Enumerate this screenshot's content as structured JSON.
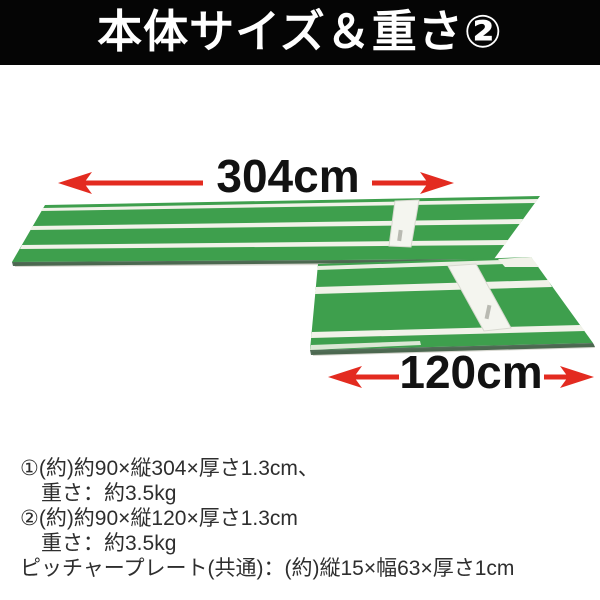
{
  "header": {
    "title": "本体サイズ＆重さ②",
    "bg_color": "#050505",
    "text_color": "#ffffff"
  },
  "diagram": {
    "long_mat": {
      "name": "投球練習マット(ロング)",
      "dimension_label": "304cm"
    },
    "short_mat": {
      "name": "投球練習マット(ショート)",
      "dimension_label": "120cm"
    },
    "colors": {
      "arrow_red": "#e32b20",
      "mat_green": "#3e9f4d",
      "stripe_white": "#f1f2e9",
      "plate_white": "#f4f5ef",
      "edge_dark": "#33543a"
    }
  },
  "specs": {
    "lines": [
      {
        "text": "①(約)約90×縦304×厚さ1.3cm、",
        "indent": false
      },
      {
        "text": "重さ：約3.5kg",
        "indent": true
      },
      {
        "text": "②(約)約90×縦120×厚さ1.3cm",
        "indent": false
      },
      {
        "text": "重さ：約3.5kg",
        "indent": true
      },
      {
        "text": "ピッチャープレート(共通)：(約)縦15×幅63×厚さ1cm",
        "indent": false
      }
    ]
  }
}
